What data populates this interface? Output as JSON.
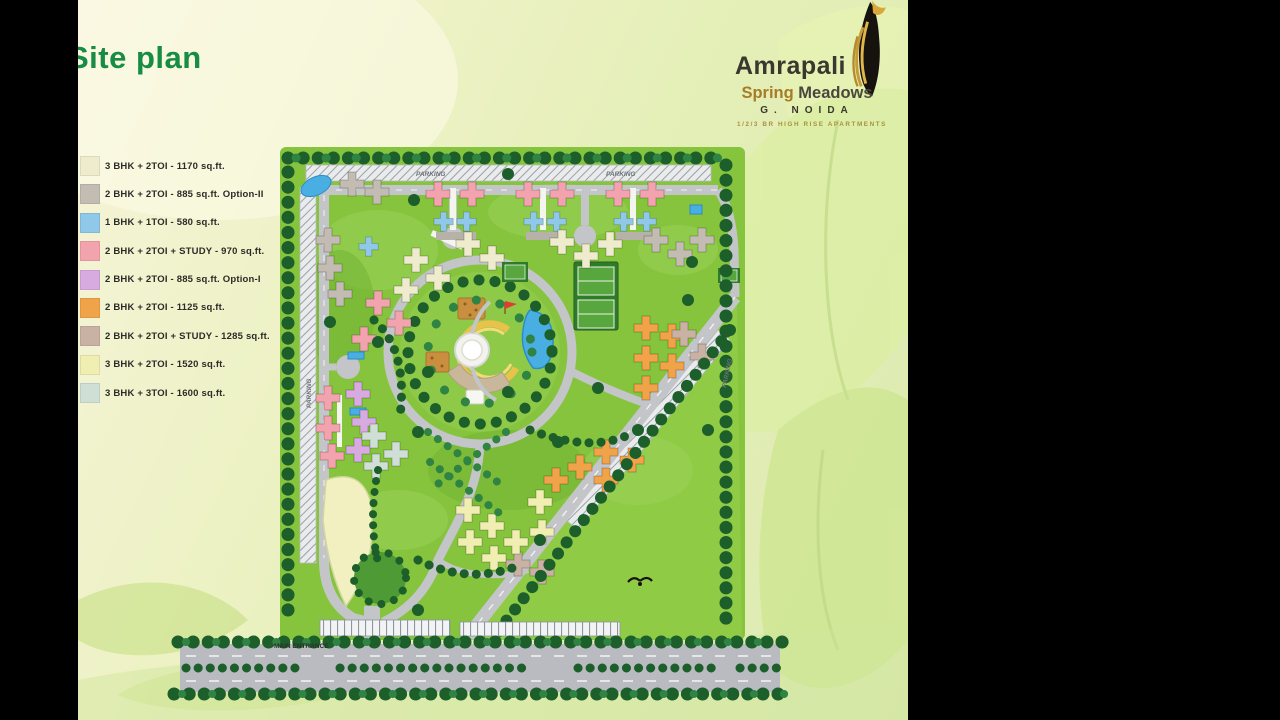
{
  "slide": {
    "title": "Site plan"
  },
  "logo": {
    "brand": "Amrapali",
    "project_first": "Spring",
    "project_second": "Meadows",
    "city": "G. NOIDA",
    "tagline": "1/2/3 BR HIGH RISE APARTMENTS"
  },
  "legend": {
    "items": [
      {
        "label": "3 BHK + 2TOI - 1170 sq.ft.",
        "color": "#efeccd"
      },
      {
        "label": "2 BHK + 2TOI - 885 sq.ft. Option-II",
        "color": "#c3bcb2"
      },
      {
        "label": "1 BHK + 1TOI - 580 sq.ft.",
        "color": "#8fc8e8"
      },
      {
        "label": "2 BHK + 2TOI + STUDY - 970 sq.ft.",
        "color": "#f2a3ae"
      },
      {
        "label": "2 BHK + 2TOI - 885 sq.ft. Option-I",
        "color": "#d8abe0"
      },
      {
        "label": "2 BHK + 2TOI - 1125 sq.ft.",
        "color": "#f0a348"
      },
      {
        "label": "2 BHK + 2TOI + STUDY - 1285 sq.ft.",
        "color": "#c9b2a4"
      },
      {
        "label": "3 BHK + 2TOI - 1520 sq.ft.",
        "color": "#f1eeb2"
      },
      {
        "label": "3 BHK + 3TOI - 1600 sq.ft.",
        "color": "#cfdfd6"
      }
    ]
  },
  "map": {
    "labels": {
      "parking": "PARKING",
      "main_entrance": "MAIN ENTRANCE"
    },
    "colors": {
      "lawn": "#86c43d",
      "road": "#c3c5c9",
      "water": "#49aee2",
      "tree": "#1c5f2b",
      "title_green": "#168c45"
    }
  }
}
